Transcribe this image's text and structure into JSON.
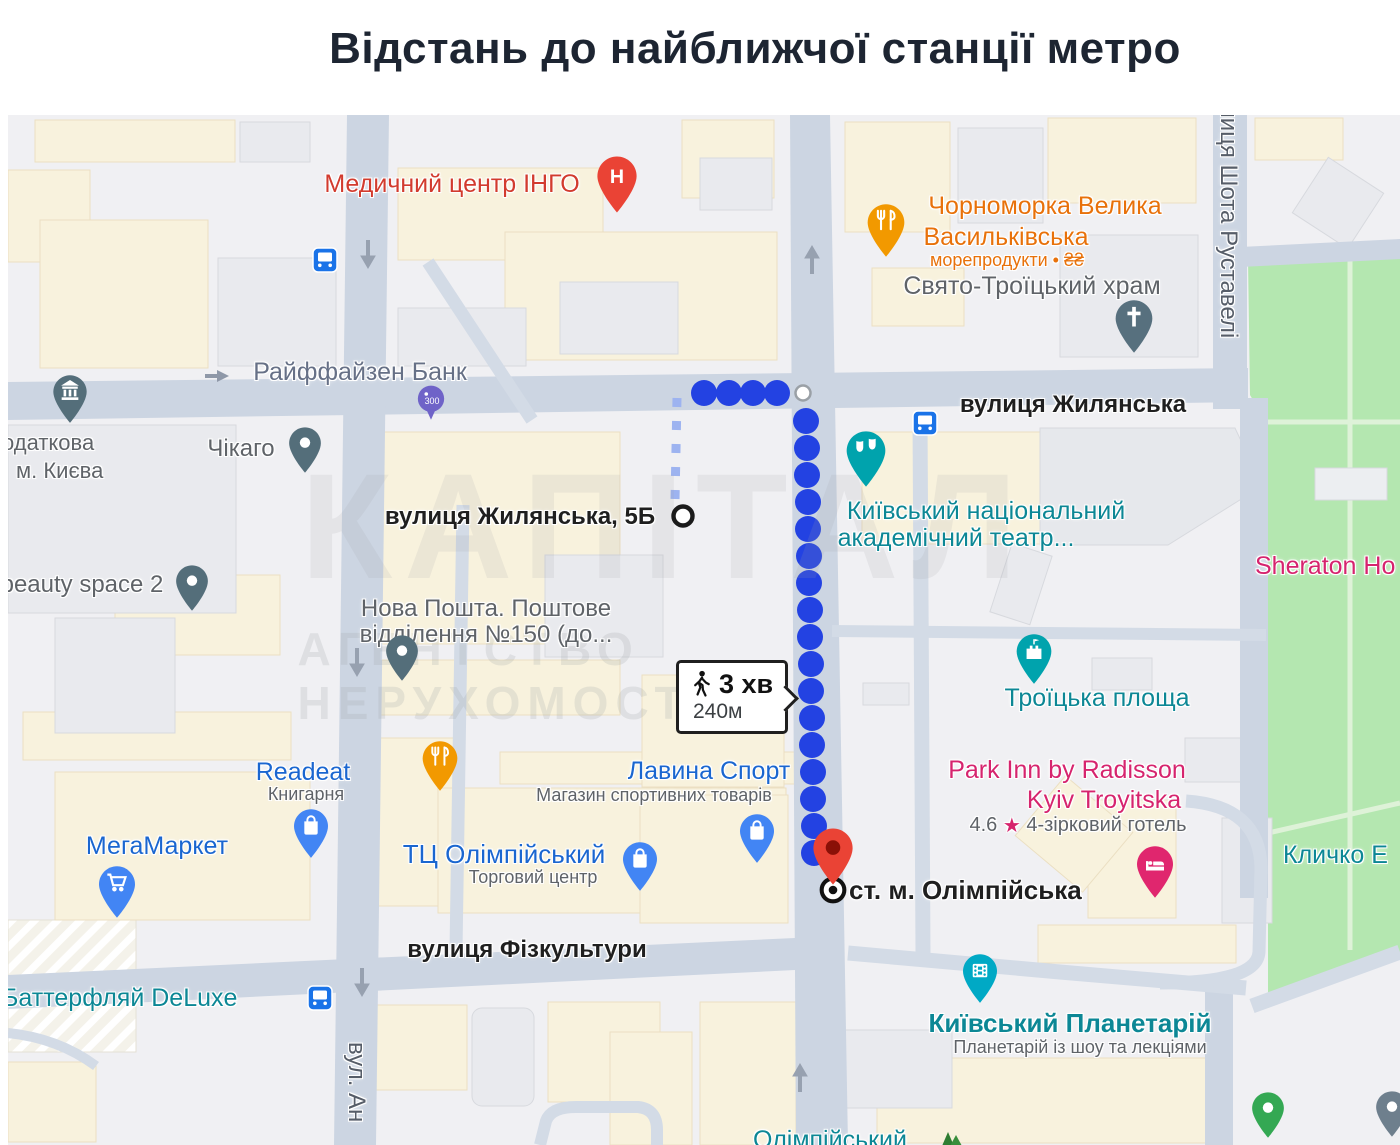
{
  "title": "Відстань до найближчої станції метро",
  "route": {
    "walk_time": "3 хв",
    "distance": "240м",
    "origin": "вулиця Жилянська, 5Б",
    "destination": "ст. м. Олімпійська"
  },
  "streets": {
    "zhylianska": "вулиця Жилянська",
    "fizkultury": "вулиця Фізкультури",
    "rustaveli": "вулиця Шота Руставелі",
    "antonovycha": "вул. Ан",
    "origin_street": "вулиця Жилянська, 5Б"
  },
  "places": {
    "med_center": "Медичний центр ІНГО",
    "raiffeisen": "Райффайзен Банк",
    "chornomorka_line1": "Чорноморка Велика",
    "chornomorka_line2": "Васильківська",
    "chornomorka_sub": "морепродукти • ₴₴",
    "hram": "Свято-Троїцький храм",
    "podatkova_line1": "одаткова",
    "podatkova_line2": "м. Києва",
    "chikago": "Чікаго",
    "beauty": "beauty space 2",
    "nova_line1": "Нова Пошта. Поштове",
    "nova_line2": "відділення №150 (до...",
    "theater_line1": "Київський національний",
    "theater_line2": "академічний театр...",
    "sheraton": "Sheraton Ho",
    "lavyna": "Лавина Спорт",
    "lavyna_sub": "Магазин спортивних товарів",
    "troitska": "Троїцька площа",
    "parkinn_line1": "Park Inn by Radisson",
    "parkinn_line2": "Kyiv Troyitska",
    "parkinn_rating": "4.6",
    "parkinn_star": "★",
    "parkinn_type": "4-зірковий готель",
    "readeat": "Readeat",
    "readeat_sub": "Книгарня",
    "megamarket": "МегаМаркет",
    "tc_olimp": "ТЦ Олімпійський",
    "tc_olimp_sub": "Торговий центр",
    "klychko": "Кличко Е",
    "butterfly": "Баттерфляй DeLuxe",
    "planetarium": "Київський Планетарій",
    "planetarium_sub": "Планетарій із шоу та лекціями",
    "olimpiyskyi_partial": "Олімпійський",
    "parking_300": "300"
  },
  "watermark": {
    "line1": "КАПІТАЛ",
    "line2": "АГЕНТСТВО НЕРУХОМОСТІ"
  },
  "icons": {
    "hospital_pin": "H-letter",
    "restaurant_pin": "fork-knife",
    "church_pin": "cross",
    "bank_pin": "bank-columns",
    "theater_pin": "theater-masks",
    "castle_pin": "fort-flag",
    "hotel_pin": "bed",
    "shop_pin": "shopping-bag",
    "supermarket_pin": "shopping-cart",
    "planetarium_pin": "film",
    "metro_station": "concentric-ring",
    "walk": "walking-person",
    "bus_stop": "bus"
  },
  "colors": {
    "route_blue": "#2342e2",
    "poi_red": "#d23b2e",
    "poi_orange": "#e8710a",
    "poi_blue": "#1a66d0",
    "poi_teal": "#0c8795",
    "poi_pink": "#d6246e",
    "poi_gray": "#5f6368",
    "road": "#ccd5e2",
    "park": "#b4e7b0",
    "building_cream": "#f8f2dd",
    "building_gray": "#e9eaee"
  }
}
